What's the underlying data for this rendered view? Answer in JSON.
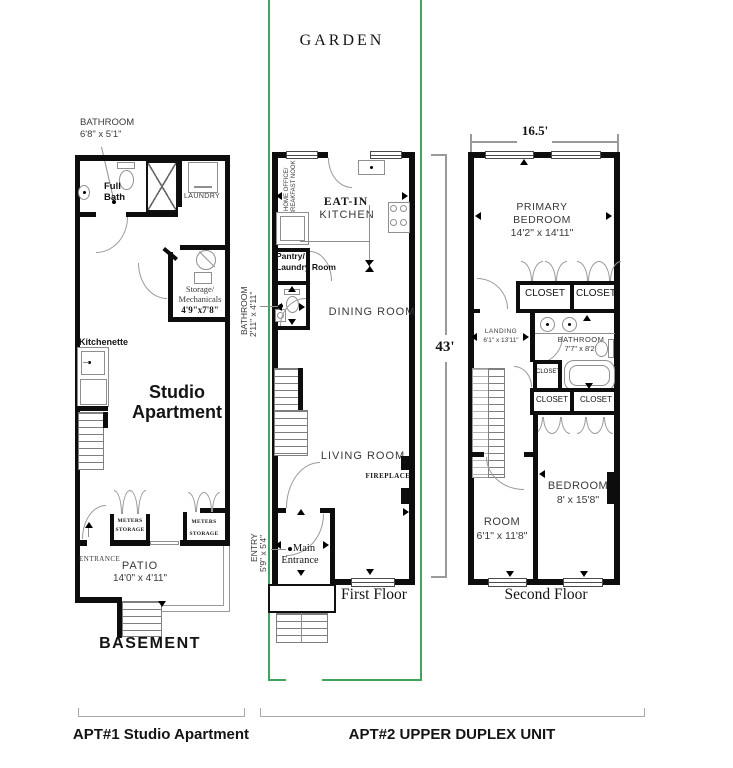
{
  "colors": {
    "wall": "#0d0d0d",
    "line": "#8f8f8f",
    "text": "#3a3a3a",
    "green": "#41a45c"
  },
  "basement": {
    "callout_room": "BATHROOM",
    "callout_dims": "6'8\" x 5'1\"",
    "full_bath_l1": "Full",
    "full_bath_l2": "Bath",
    "laundry": "LAUNDRY",
    "storage_l1": "Storage/",
    "storage_l2": "Mechanicals",
    "storage_l3": "4'9\"x7'8\"",
    "kitchenette": "Kitchenette",
    "studio_l1": "Studio",
    "studio_l2": "Apartment",
    "meters1_l1": "METERS",
    "meters1_l2": "STORAGE",
    "meters2_l1": "METERS",
    "meters2_l2": "STORAGE",
    "entrance": "ENTRANCE",
    "patio": "PATIO",
    "patio_dims": "14'0\" x 4'11\"",
    "floor_label": "BASEMENT"
  },
  "first_floor": {
    "garden": "GARDEN",
    "home_office_l1": "HOME OFFICE/",
    "home_office_l2": "BREAKFAST NOOK",
    "eat_in": "EAT-IN",
    "kitchen": "KITCHEN",
    "pantry_l1": "Pantry/",
    "pantry_l2": "Laundry Room",
    "bathroom": "BATHROOM",
    "bathroom_dims": "2'11\" x 4'11\"",
    "dining": "DINING ROOM",
    "living": "LIVING ROOM",
    "fireplace": "FIREPLACE",
    "entry": "ENTRY",
    "entry_dims": "5'9\" x 5'4\"",
    "main_l1": "Main",
    "main_l2": "Entrance",
    "floor_label": "First Floor",
    "height_dim": "43'"
  },
  "second_floor": {
    "width_dim": "16.5'",
    "primary_l1": "PRIMARY",
    "primary_l2": "BEDROOM",
    "primary_dims": "14'2\" x 14'11\"",
    "closet1": "CLOSET",
    "closet2": "CLOSET",
    "closet3": "CLOSET",
    "closet4": "CLOSET",
    "closet5": "CLOSET",
    "landing": "LANDING",
    "landing_dims": "6'1\" x 13'11\"",
    "bathroom": "BATHROOM",
    "bathroom_dims": "7'7\" x 8'2\"",
    "bedroom": "BEDROOM",
    "bedroom_dims": "8' x 15'8\"",
    "room": "ROOM",
    "room_dims": "6'1\" x 11'8\"",
    "floor_label": "Second Floor"
  },
  "footer": {
    "apt1": "APT#1  Studio Apartment",
    "apt2": "APT#2  UPPER DUPLEX UNIT"
  }
}
